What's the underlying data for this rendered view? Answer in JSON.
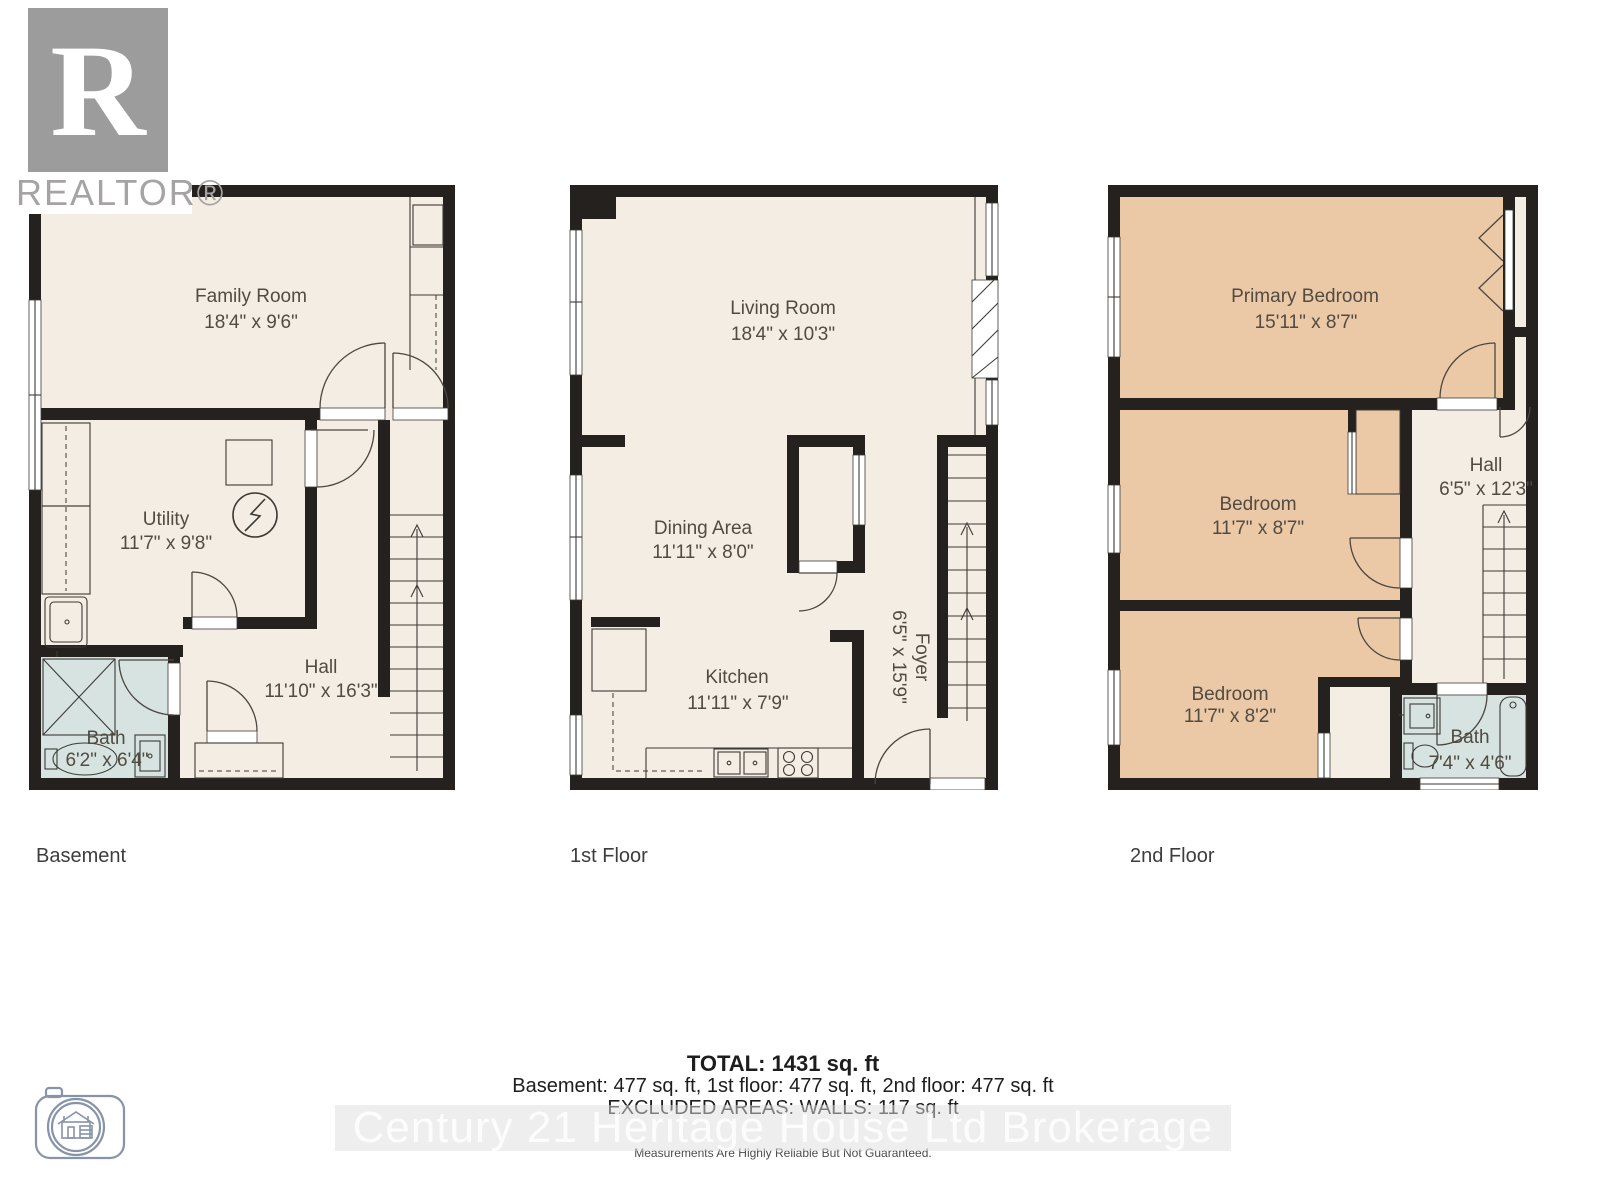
{
  "branding": {
    "realtor_logo_letter": "R",
    "realtor_logo_text": "REALTOR®",
    "watermark": "Century 21 Heritage House Ltd Brokerage"
  },
  "floors": [
    {
      "label": "Basement",
      "rooms": [
        {
          "name": "Family Room",
          "dims": "18'4\" x 9'6\""
        },
        {
          "name": "Utility",
          "dims": "11'7\" x 9'8\""
        },
        {
          "name": "Hall",
          "dims": "11'10\" x 16'3\""
        },
        {
          "name": "Bath",
          "dims": "6'2\" x 6'4\""
        }
      ]
    },
    {
      "label": "1st Floor",
      "rooms": [
        {
          "name": "Living Room",
          "dims": "18'4\" x 10'3\""
        },
        {
          "name": "Dining Area",
          "dims": "11'11\" x 8'0\""
        },
        {
          "name": "Kitchen",
          "dims": "11'11\" x 7'9\""
        },
        {
          "name": "Foyer",
          "dims": "6'5\" x 15'9\""
        }
      ]
    },
    {
      "label": "2nd Floor",
      "rooms": [
        {
          "name": "Primary Bedroom",
          "dims": "15'11\" x 8'7\""
        },
        {
          "name": "Bedroom",
          "dims": "11'7\" x 8'7\""
        },
        {
          "name": "Bedroom",
          "dims": "11'7\" x 8'2\""
        },
        {
          "name": "Hall",
          "dims": "6'5\" x 12'3\""
        },
        {
          "name": "Bath",
          "dims": "7'4\" x 4'6\""
        }
      ]
    }
  ],
  "summary": {
    "total": "TOTAL: 1431 sq. ft",
    "breakdown": "Basement: 477 sq. ft, 1st floor: 477 sq. ft, 2nd floor: 477 sq. ft",
    "excluded": "EXCLUDED AREAS: WALLS: 117 sq. ft",
    "disclaimer": "Measurements Are Highly Reliable But Not Guaranteed."
  },
  "colors": {
    "wall": "#24211e",
    "floor_fill": "#f4ede3",
    "bedroom_fill": "#ecc9a6",
    "bath_fill": "#d6e3e1",
    "logo_gray": "#9c9c9c",
    "watermark_band": "#dddddd"
  }
}
